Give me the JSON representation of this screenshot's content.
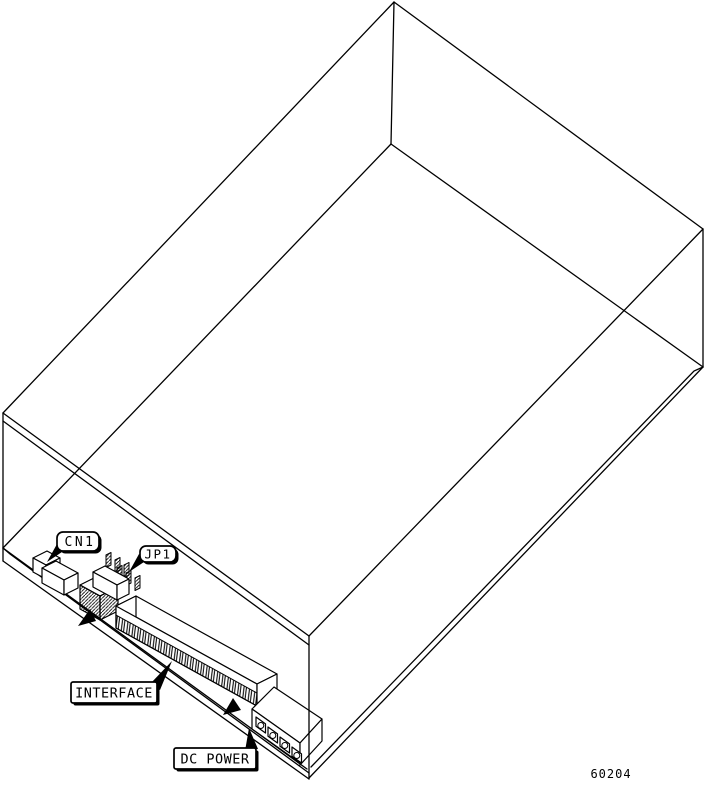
{
  "diagram": {
    "part_number": "60204",
    "callouts": [
      {
        "label": "CN1"
      },
      {
        "label": "JP1"
      },
      {
        "label": "INTERFACE"
      },
      {
        "label": "DC POWER"
      }
    ]
  }
}
